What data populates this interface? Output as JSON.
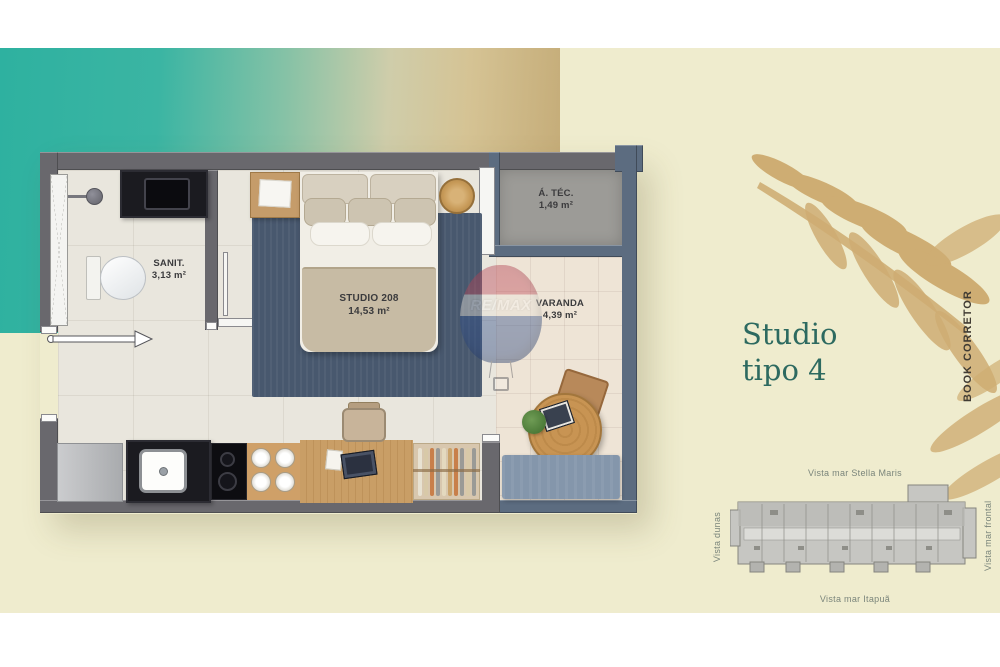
{
  "floor_plan": {
    "rooms": {
      "sanit": {
        "label": "SANIT.",
        "area": "3,13 m²"
      },
      "studio": {
        "label": "STUDIO 208",
        "area": "14,53 m²"
      },
      "atec": {
        "label": "Á. TÉC.",
        "area": "1,49 m²"
      },
      "varanda": {
        "label": "VARANDA",
        "area": "4,39 m²"
      }
    },
    "watermark": "RE/MAX"
  },
  "side_panel": {
    "title_line1": "Studio",
    "title_line2": "tipo 4",
    "book_label": "BOOK CORRETOR",
    "key_plan": {
      "top": "Vista mar Stella Maris",
      "bottom": "Vista mar Itapuã",
      "left": "Vista dunas",
      "right": "Vista mar frontal"
    }
  },
  "colors": {
    "teal": "#2fb2a1",
    "sand": "#c4ab77",
    "cream": "#efecce",
    "title_teal": "#2d6a60",
    "wall_gray": "#69686d",
    "wall_slate": "#5c6c80",
    "rug_navy": "#48586e",
    "balloon_red": "#b53e50",
    "balloon_blue": "#27427c",
    "gold_leaf": "#c79e5d"
  }
}
